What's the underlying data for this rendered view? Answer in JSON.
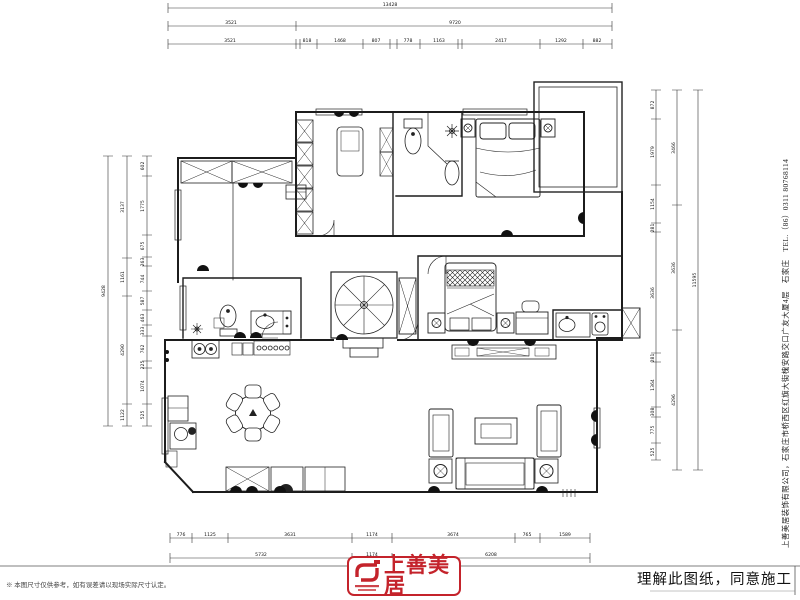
{
  "dimensions": {
    "top": {
      "total": "13428",
      "row2": [
        "3521",
        "9720"
      ],
      "row3": [
        "3521",
        "818",
        "1468",
        "807",
        "778",
        "1163",
        "2417",
        "1292",
        "882"
      ]
    },
    "bottom": {
      "row1": [
        "776",
        "1125",
        "3631",
        "1174",
        "3674",
        "765",
        "1589"
      ],
      "row2": [
        "5732",
        "1174",
        "6208"
      ]
    },
    "left": {
      "outer": "9428",
      "middle": [
        "3137",
        "1161",
        "4290",
        "1122"
      ],
      "inner": [
        "602",
        "1775",
        "675",
        "263",
        "744",
        "587",
        "463",
        "333",
        "762",
        "225",
        "1074",
        "525"
      ]
    },
    "right": {
      "outer": "11595",
      "middle": [
        "3466",
        "3636",
        "4296"
      ],
      "inner": [
        "872",
        "1979",
        "1154",
        "281",
        "3636",
        "281",
        "1364",
        "308",
        "775",
        "525"
      ]
    }
  },
  "title_block": {
    "logo_text": "上善美居",
    "approval_text": "理解此图纸，同意施工",
    "disclaimer": "※ 本图尺寸仅供参考，如有误差请以现场实际尺寸认定。",
    "company_info": "上善美居装饰有限公司，石家庄市桥西区红旗大街槐安路交口广友大厦4层　石家庄　TEL.（86）0311 80768114",
    "brand_color": "#c4232b"
  }
}
